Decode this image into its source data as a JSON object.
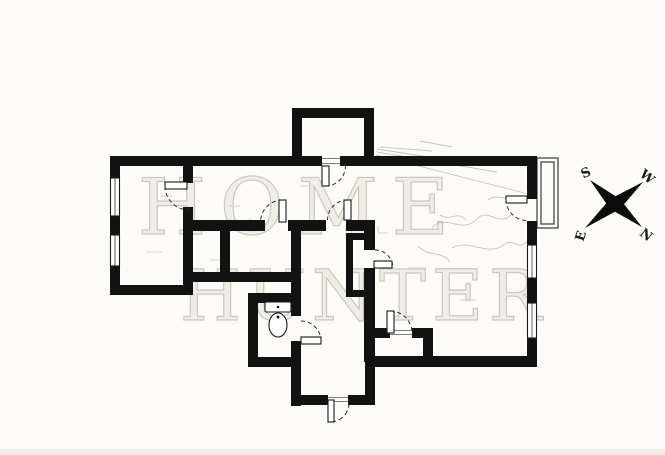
{
  "colors": {
    "background": "#fcfbf8",
    "wall": "#121212",
    "watermark_fill": "#efede8",
    "watermark_stroke": "#cbc8c2",
    "sketch": "#bdbab4",
    "compass": "#0c0c0c"
  },
  "watermark": {
    "line1": "HOME",
    "line2": "HUNTER"
  },
  "compass": {
    "top_left": "S",
    "top_right": "W",
    "bottom_left": "E",
    "bottom_right": "N"
  },
  "plan": {
    "icons": {
      "toilet": "toilet-icon",
      "compass_rose": "compass-rose-icon",
      "window": "window-icon",
      "door_swing": "door-swing-icon",
      "balcony": "balcony-icon"
    }
  }
}
